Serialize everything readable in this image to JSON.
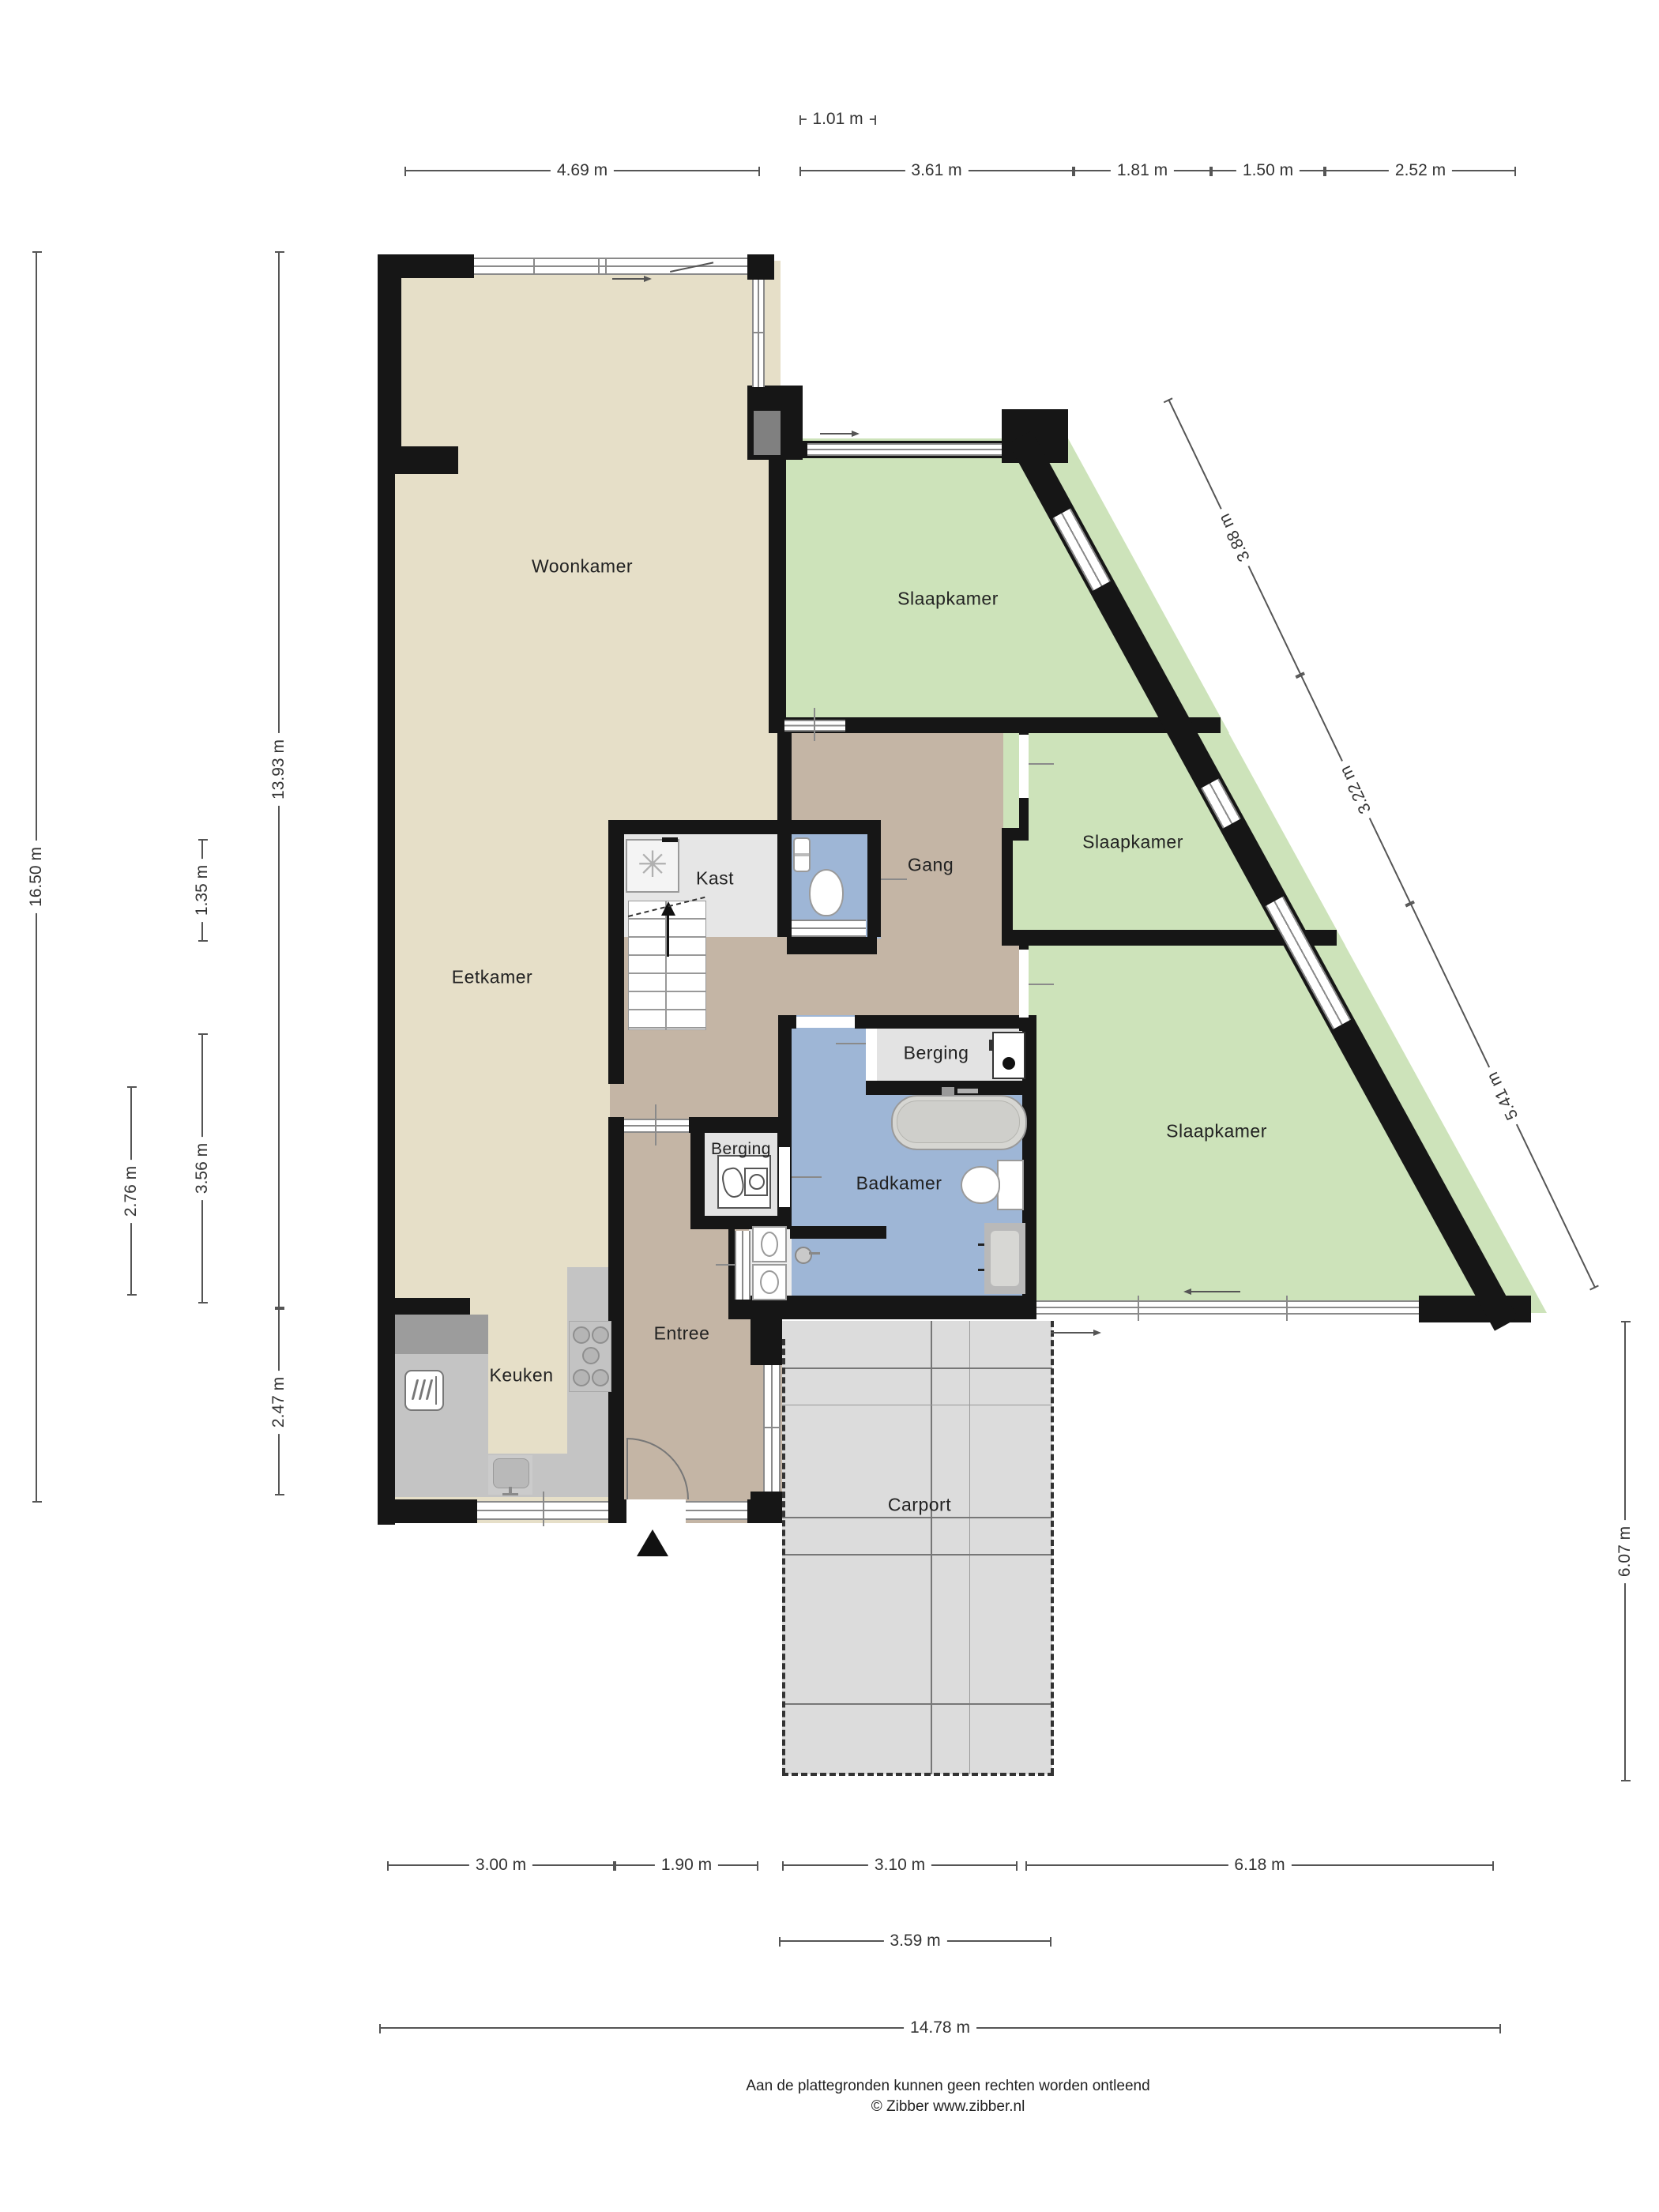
{
  "rooms": {
    "woonkamer": "Woonkamer",
    "eetkamer": "Eetkamer",
    "keuken": "Keuken",
    "entree": "Entree",
    "kast": "Kast",
    "gang": "Gang",
    "berging_gang": "Berging",
    "berging_entree": "Berging",
    "badkamer": "Badkamer",
    "slaapkamer_boven": "Slaapkamer",
    "slaapkamer_midden": "Slaapkamer",
    "slaapkamer_onder": "Slaapkamer",
    "carport": "Carport"
  },
  "dims": {
    "top_inset": "1.01 m",
    "top": [
      "4.69 m",
      "3.61 m",
      "1.81 m",
      "1.50 m",
      "2.52 m"
    ],
    "left": [
      "16.50 m",
      "13.93 m",
      "1.35 m",
      "3.56 m",
      "2.76 m",
      "2.47 m"
    ],
    "diagonal": [
      "3.88 m",
      "3.22 m",
      "5.41 m"
    ],
    "right": "6.07 m",
    "bottom_row1": [
      "3.00 m",
      "1.90 m",
      "3.10 m",
      "6.18 m"
    ],
    "bottom_row2": "3.59 m",
    "bottom_row3": "14.78 m"
  },
  "footer": {
    "line1": "Aan de plattegronden kunnen geen rechten worden ontleend",
    "line2": "© Zibber www.zibber.nl"
  },
  "colors": {
    "wall": "#161616",
    "living_floor": "#e6dfc8",
    "hall_floor": "#c4b5a5",
    "bedroom_floor": "#cde3ba",
    "bathroom_floor": "#9eb6d6",
    "storage_floor": "#e3e3e3",
    "counter": "#c4c4c4",
    "carport_floor": "#dcdcdc"
  }
}
